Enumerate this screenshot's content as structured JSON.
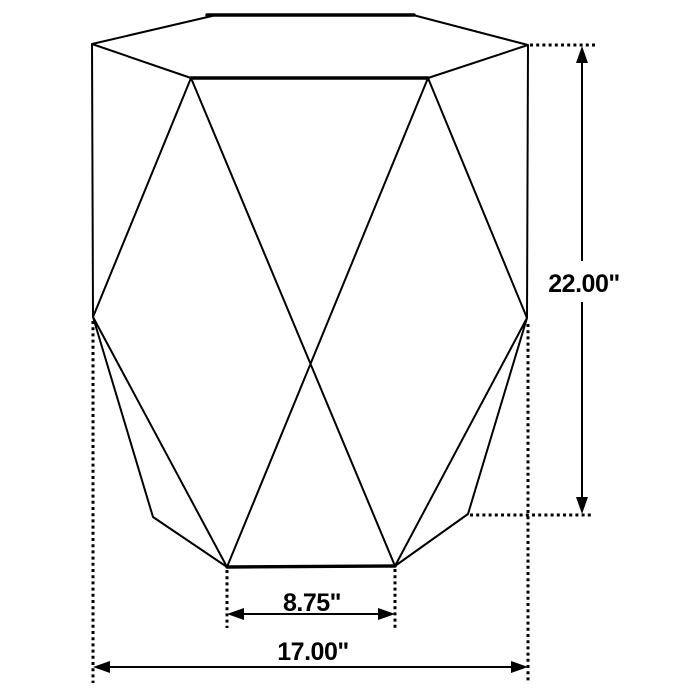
{
  "page": {
    "background": "#ffffff",
    "line_color": "#000000"
  },
  "diagram": {
    "subject": "hexagonal faceted accent table - dimension line drawing",
    "dimensions": {
      "height": {
        "label": "22.00\""
      },
      "base_front_width": {
        "label": "8.75\""
      },
      "overall_width": {
        "label": "17.00\""
      }
    }
  }
}
